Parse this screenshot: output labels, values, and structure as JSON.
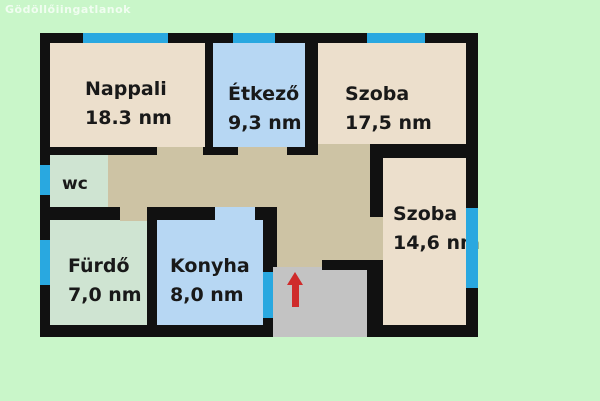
{
  "watermark": "Gödöllőiingatlanok",
  "unit_note": "nm",
  "rooms": {
    "nappali": {
      "name": "Nappali",
      "area": "18.3 nm"
    },
    "etkezo": {
      "name": "Étkező",
      "area": "9,3 nm"
    },
    "szoba17": {
      "name": "Szoba",
      "area": "17,5 nm"
    },
    "wc": {
      "name": "wc",
      "area": ""
    },
    "furdo": {
      "name": "Fürdő",
      "area": "7,0 nm"
    },
    "konyha": {
      "name": "Konyha",
      "area": "8,0 nm"
    },
    "szoba14": {
      "name": "Szoba",
      "area": "14,6 nm"
    }
  },
  "features": {
    "entrance_arrow": "red arrow pointing up at entry area",
    "windows": [
      "nappali-top",
      "etkezo-top",
      "szoba17-top",
      "wc-left",
      "furdo-left",
      "szoba14-right"
    ]
  },
  "colors": {
    "background": "#c9f6c9",
    "wall": "#111111",
    "window": "#29a8e0",
    "beige": "#ecdfcc",
    "blue": "#b7d7f3",
    "green": "#cfe4d2",
    "tan": "#cdc3a4",
    "gray": "#c3c3c3",
    "arrow": "#cf2b2b"
  }
}
